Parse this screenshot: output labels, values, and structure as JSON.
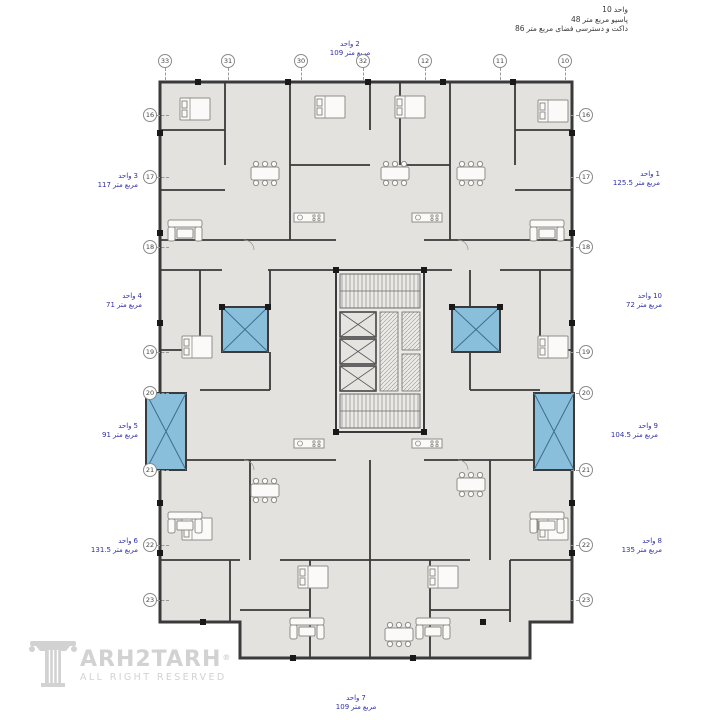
{
  "annotation": {
    "lines": [
      "10 واحد",
      "48 متر مربع پاسیو",
      "86 متر مربع فضای دسترسی و داکت"
    ]
  },
  "plan": {
    "units": [
      {
        "id": 1,
        "name": "واحد 1",
        "area": "125.5 متر مربع",
        "side": "right"
      },
      {
        "id": 2,
        "name": "واحد 2",
        "area": "109 متر مربع",
        "side": "top"
      },
      {
        "id": 3,
        "name": "واحد 3",
        "area": "117 متر مربع",
        "side": "left"
      },
      {
        "id": 4,
        "name": "واحد 4",
        "area": "71 متر مربع",
        "side": "left"
      },
      {
        "id": 5,
        "name": "واحد 5",
        "area": "91 متر مربع",
        "side": "left"
      },
      {
        "id": 6,
        "name": "واحد 6",
        "area": "131.5 متر مربع",
        "side": "left"
      },
      {
        "id": 7,
        "name": "واحد 7",
        "area": "109 متر مربع",
        "side": "bottom"
      },
      {
        "id": 8,
        "name": "واحد 8",
        "area": "135 متر مربع",
        "side": "right"
      },
      {
        "id": 9,
        "name": "واحد 9",
        "area": "104.5 متر مربع",
        "side": "right"
      },
      {
        "id": 10,
        "name": "واحد 10",
        "area": "72 متر مربع",
        "side": "right"
      }
    ],
    "grid_bubbles": {
      "top": [
        "33",
        "31",
        "30",
        "32",
        "12",
        "11",
        "10"
      ],
      "left": [
        "16",
        "17",
        "18",
        "19",
        "20",
        "21",
        "22",
        "23"
      ],
      "right": [
        "16",
        "17",
        "18",
        "19",
        "20",
        "21",
        "22",
        "23"
      ]
    },
    "colors": {
      "wall": "#3a3a3a",
      "floor": "#e4e2de",
      "patio": "#8abfdc",
      "patio_line": "#3f6e8c",
      "unit_label": "#2f2fae",
      "annotation_text": "#3a3a3a",
      "furniture": "#8f8d89",
      "logo": "#d2d2d2"
    },
    "icons": {
      "staircase": "stair-treads-hatch",
      "elevator": "x-crossed-shaft",
      "patio": "blue-x-crossed-rect",
      "duct": "diagonal-hatch"
    }
  },
  "logo": {
    "brand_text": "ARH2TARH",
    "registered": "®",
    "tagline": "ALL RIGHT RESERVED",
    "column_icon": "classical-column-forming-letter-T"
  }
}
